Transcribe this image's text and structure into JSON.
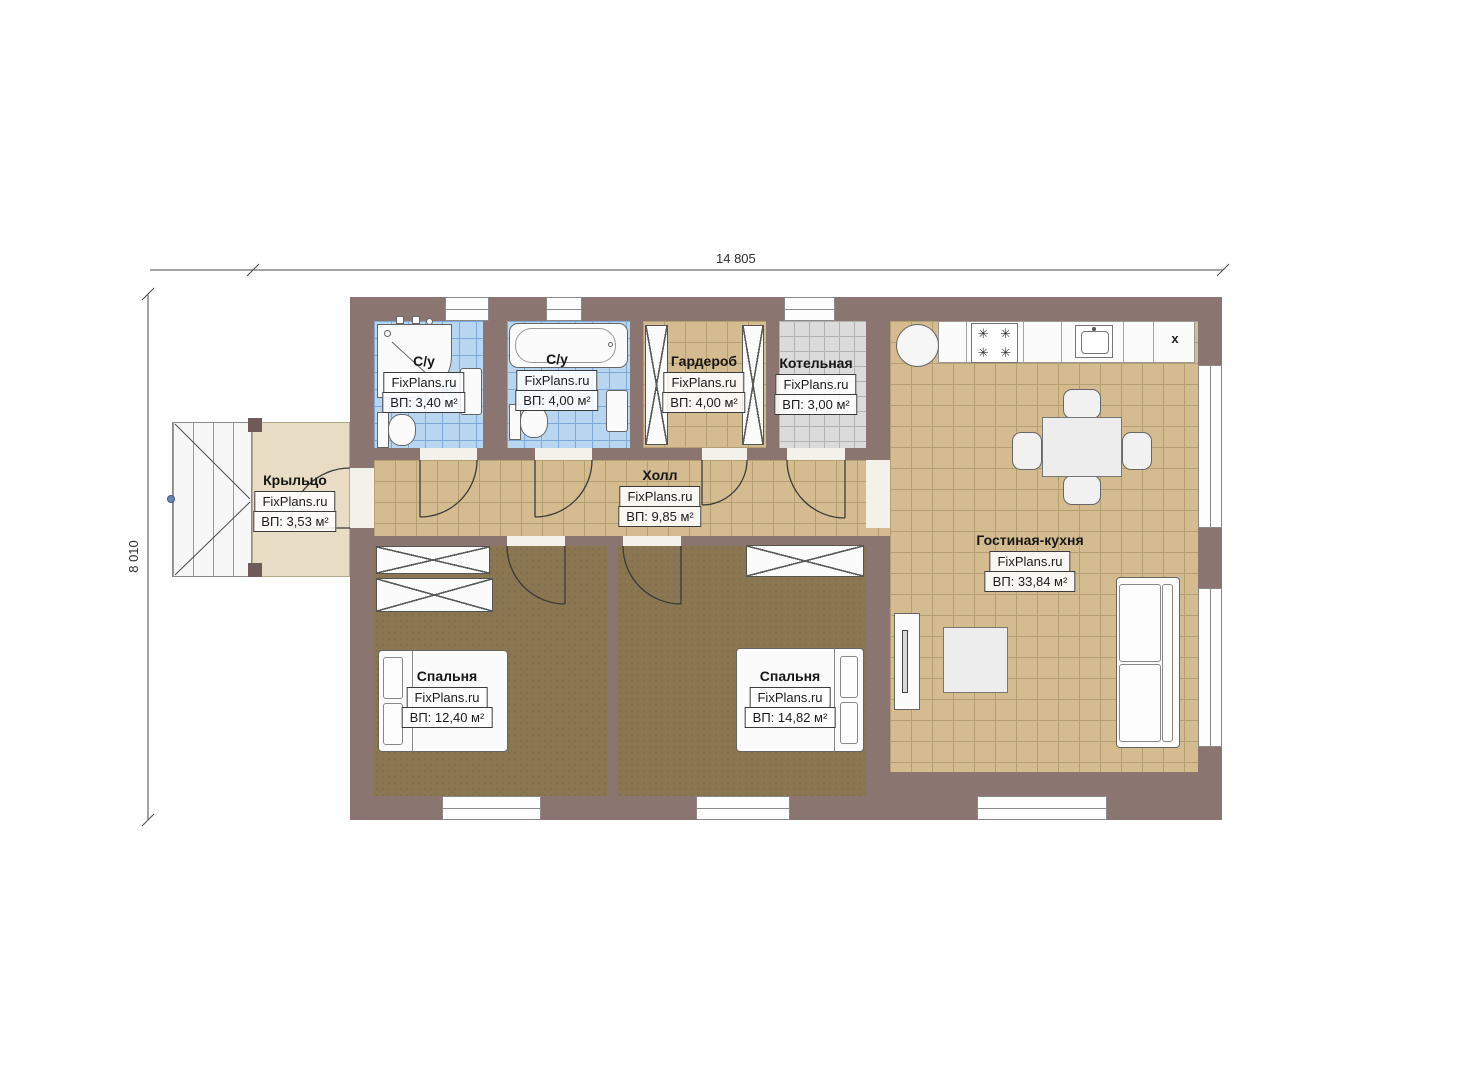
{
  "plan_title": "floor plan",
  "watermark": "FixPlans.ru",
  "dimensions": {
    "width": "14 805",
    "height": "8 010"
  },
  "rooms": {
    "bathroom_1": {
      "name": "С/у",
      "watermark": "FixPlans.ru",
      "area": "ВП: 3,40 м²"
    },
    "bathroom_2": {
      "name": "С/у",
      "watermark": "FixPlans.ru",
      "area": "ВП: 4,00 м²"
    },
    "wardrobe": {
      "name": "Гардероб",
      "watermark": "FixPlans.ru",
      "area": "ВП: 4,00 м²"
    },
    "boiler": {
      "name": "Котельная",
      "watermark": "FixPlans.ru",
      "area": "ВП: 3,00 м²"
    },
    "living": {
      "name": "Гостиная-кухня",
      "watermark": "FixPlans.ru",
      "area": "ВП: 33,84 м²"
    },
    "hall": {
      "name": "Холл",
      "watermark": "FixPlans.ru",
      "area": "ВП: 9,85 м²"
    },
    "porch": {
      "name": "Крыльцо",
      "watermark": "FixPlans.ru",
      "area": "ВП: 3,53 м²"
    },
    "bedroom_1": {
      "name": "Спальня",
      "watermark": "FixPlans.ru",
      "area": "ВП: 12,40 м²"
    },
    "bedroom_2": {
      "name": "Спальня",
      "watermark": "FixPlans.ru",
      "area": "ВП: 14,82 м²"
    }
  },
  "kitchen": {
    "vent_label": "x",
    "burner_glyph": "✳"
  },
  "colors": {
    "wall": "#8b7571",
    "floor_tan": "#d5bc90",
    "floor_brown": "#8a7650",
    "tile_blue": "#b9d6f1",
    "tile_gray": "#dbdbdb",
    "porch": "#e8dcc4"
  }
}
